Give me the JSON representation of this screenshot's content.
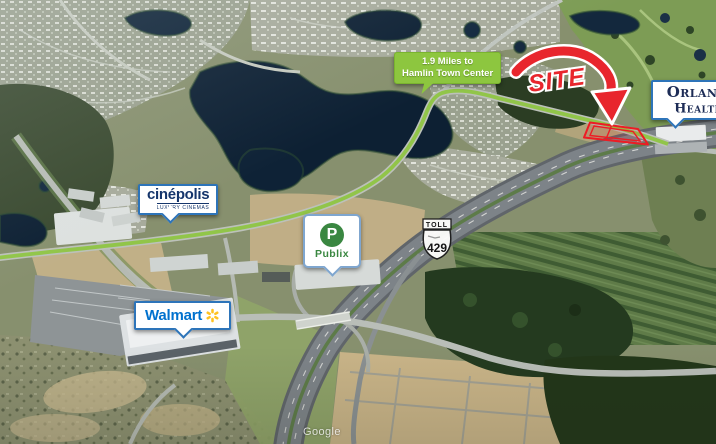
{
  "map": {
    "attribution": "Google",
    "site": {
      "label": "SITE"
    },
    "route_label": {
      "line1": "1.9 Miles to",
      "line2": "Hamlin Town Center"
    },
    "toll_shield": {
      "banner": "TOLL",
      "route_number": "429"
    },
    "tenant_labels": {
      "cinepolis": {
        "name": "cinépolis",
        "tagline": "LUXURY CINEMAS"
      },
      "publix": {
        "monogram": "P",
        "name": "Publix"
      },
      "walmart": {
        "name": "Walmart"
      },
      "orlando_health": {
        "line1": "Orlando",
        "line2": "Health",
        "registered_mark": "®"
      }
    },
    "colors": {
      "site_red": "#E8262D",
      "route_green": "#8DC63F",
      "walmart_blue": "#0071CE",
      "walmart_spark_yellow": "#FFC220",
      "publix_green": "#3A8741",
      "cinepolis_navy": "#15356B",
      "orlando_health_navy": "#1D2C56",
      "callout_border_blue": "#2D74B9",
      "water_navy": "#0D2033"
    }
  }
}
